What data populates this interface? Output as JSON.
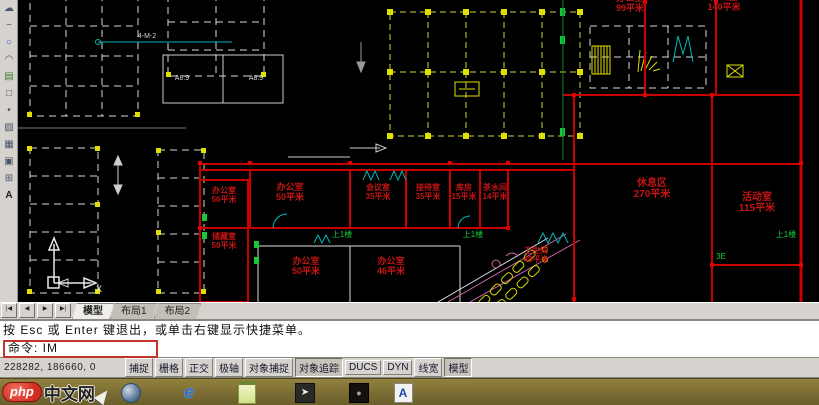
{
  "app": {
    "name": "AutoCAD drawing session"
  },
  "toolbar": {
    "icons": [
      {
        "name": "revision-cloud-icon",
        "glyph": "☁"
      },
      {
        "name": "spline-icon",
        "glyph": "~"
      },
      {
        "name": "ellipse-icon",
        "glyph": "○"
      },
      {
        "name": "ellipse-arc-icon",
        "glyph": "◠"
      },
      {
        "name": "insert-block-icon",
        "glyph": "▤"
      },
      {
        "name": "make-block-icon",
        "glyph": "□"
      },
      {
        "name": "point-icon",
        "glyph": "•"
      },
      {
        "name": "hatch-icon",
        "glyph": "▨"
      },
      {
        "name": "gradient-icon",
        "glyph": "▦"
      },
      {
        "name": "region-icon",
        "glyph": "▣"
      },
      {
        "name": "table-icon",
        "glyph": "⊞"
      },
      {
        "name": "mtext-icon",
        "glyph": "A"
      }
    ]
  },
  "drawing": {
    "rooms": [
      {
        "name": "办公室",
        "area": "50平米"
      },
      {
        "name": "会议室",
        "area": "35平米"
      },
      {
        "name": "接待室",
        "area": "35平米"
      },
      {
        "name": "库房",
        "area": "15平米"
      },
      {
        "name": "茶水间",
        "area": "14平米"
      },
      {
        "name": "办公室",
        "area": "56平米"
      },
      {
        "name": "储藏室",
        "area": "50平米"
      },
      {
        "name": "办公室",
        "area": "50平米"
      },
      {
        "name": "办公室",
        "area": "46平米"
      },
      {
        "name": "卫生间",
        "area": "48平米"
      },
      {
        "name": "休息区",
        "area": "270平米"
      },
      {
        "name": "活动室",
        "area": "115平米"
      },
      {
        "name": "办公室",
        "area": "99平米"
      },
      {
        "name": "办公室",
        "area": "140平米"
      }
    ],
    "corridor_labels": [
      "上1楼",
      "上1楼",
      "上1楼"
    ],
    "grid_label": "4-M-2",
    "room_tags": [
      "A8.9",
      "A8.9"
    ],
    "stair_label": "3E",
    "ucs_axis_label": "X"
  },
  "tabs": {
    "nav": [
      "|◀",
      "◀",
      "▶",
      "▶|"
    ],
    "items": [
      {
        "label": "模型"
      },
      {
        "label": "布局1"
      },
      {
        "label": "布局2"
      }
    ]
  },
  "command": {
    "line1": "按 Esc 或 Enter 键退出，或单击右键显示快捷菜单。",
    "prompt": "命令: IM"
  },
  "statusbar": {
    "coordinates": "228282, 186660, 0",
    "buttons": [
      {
        "label": "捕捉",
        "pressed": false
      },
      {
        "label": "栅格",
        "pressed": false
      },
      {
        "label": "正交",
        "pressed": false
      },
      {
        "label": "极轴",
        "pressed": false
      },
      {
        "label": "对象捕捉",
        "pressed": false
      },
      {
        "label": "对象追踪",
        "pressed": true
      },
      {
        "label": "DUCS",
        "pressed": false
      },
      {
        "label": "DYN",
        "pressed": false
      },
      {
        "label": "线宽",
        "pressed": false
      },
      {
        "label": "模型",
        "pressed": true
      }
    ]
  },
  "taskbar": {
    "watermark_badge": "php",
    "watermark_text": "中文网",
    "icons": [
      "network-globe-icon",
      "internet-explorer-icon",
      "notepad-icon",
      "pointer-tool-icon",
      "media-player-icon",
      "autocad-icon"
    ]
  },
  "colors": {
    "wall_red": "#c80000",
    "hatch_yellow": "#e0e000",
    "marker_green": "#16c93c",
    "dim_cyan": "#00b7b7",
    "fixture_pink": "#cc66aa",
    "canvas_black": "#000000",
    "taskbar_olive": "#7a6c33",
    "annotation_red": "#c2342a"
  }
}
